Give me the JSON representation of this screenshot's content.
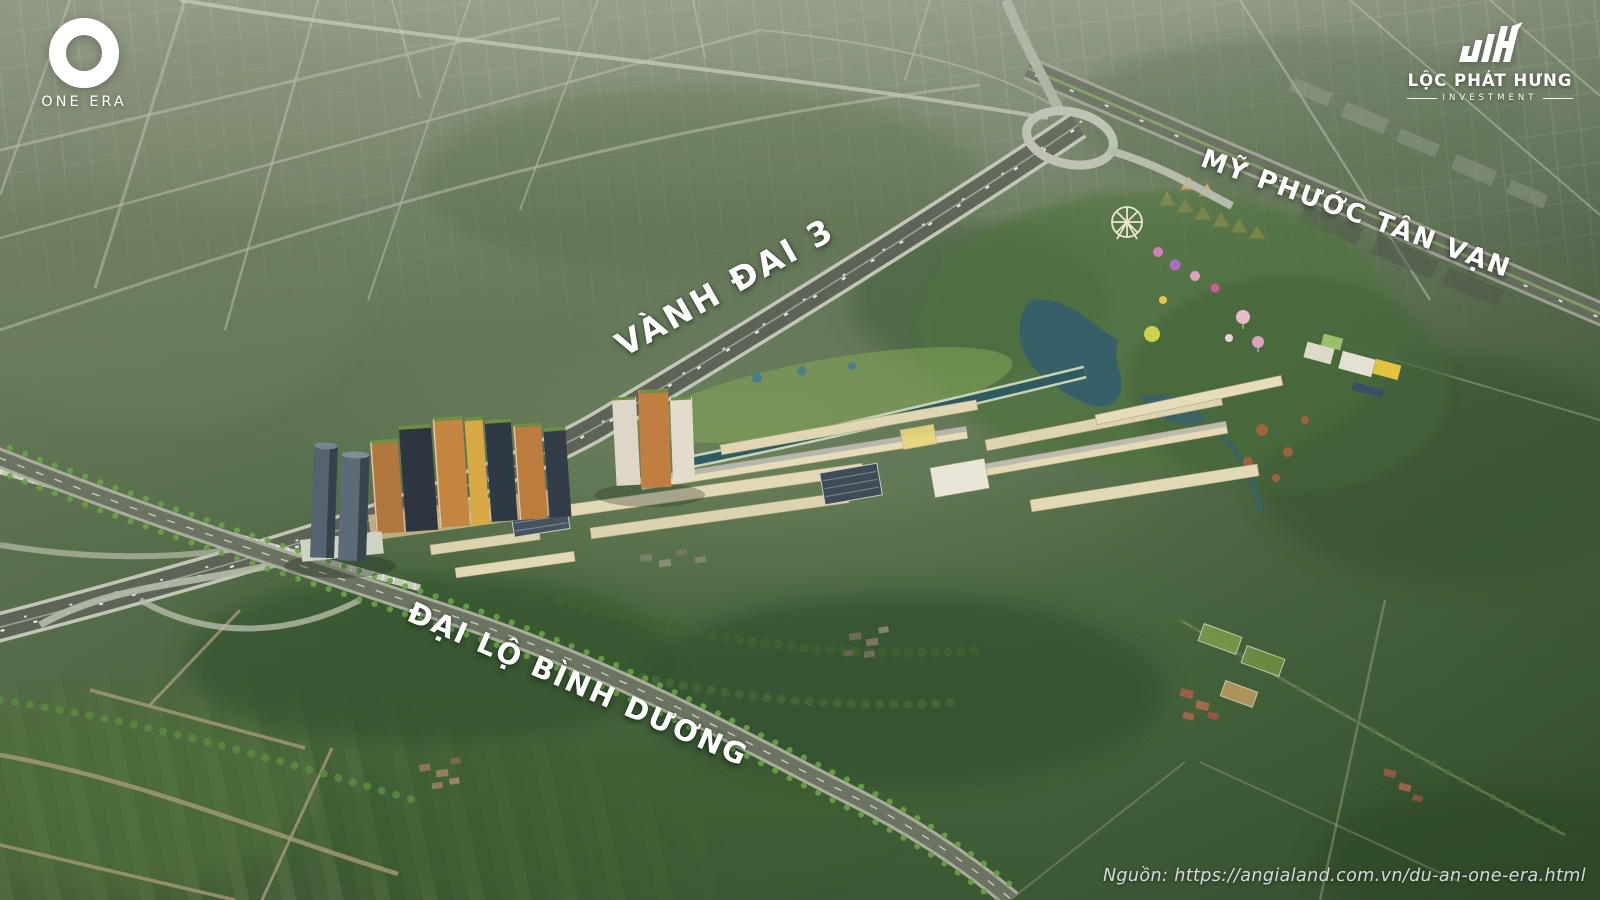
{
  "page": {
    "type": "aerial-masterplan-render",
    "project_name": "ONE ERA"
  },
  "logos": {
    "one_era": {
      "label": "ONE ERA"
    },
    "loc_phat_hung": {
      "name": "LỘC PHÁT HƯNG",
      "subtitle": "INVESTMENT"
    }
  },
  "road_labels": {
    "ring_road": "VÀNH ĐAI 3",
    "my_phuoc_tan_van": "MỸ PHƯỚC TÂN VẠN",
    "binh_duong_blvd": "ĐẠI LỘ BÌNH DƯƠNG"
  },
  "attribution": "Nguồn: https://angialand.com.vn/du-an-one-era.html",
  "colors": {
    "label_text": "#ffffff",
    "logo_text": "#ffffff",
    "attribution_text": "#d6dade",
    "terrain_top": "#8b9580",
    "terrain_bottom": "#3b5733",
    "water": "#39646c",
    "highway_dark": "#5d6457",
    "highway_edge": "#c2c6b6",
    "townhouse": "#e2d8b6",
    "tower_orange": "#c08045",
    "tower_glass": "#4d5d69",
    "tent_gold": "#d9b267"
  }
}
